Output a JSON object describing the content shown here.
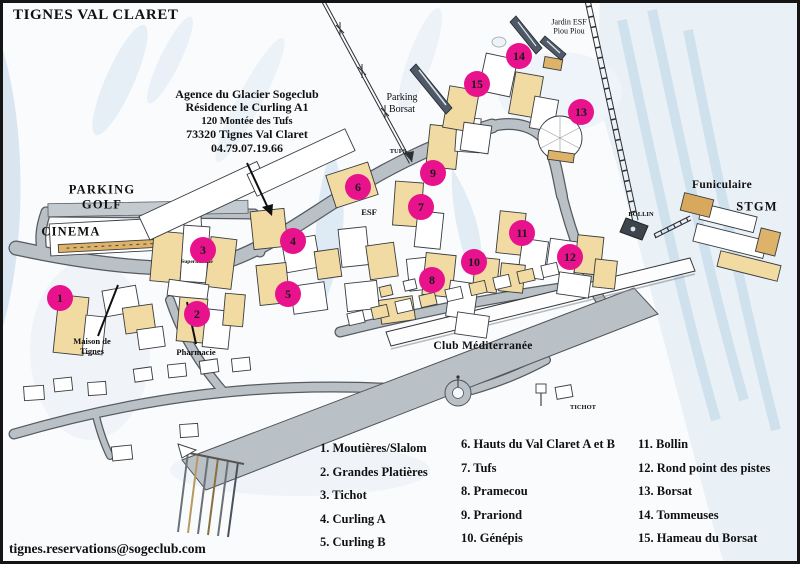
{
  "title": "TIGNES VAL CLARET",
  "agency": {
    "lines": [
      "Agence du Glacier Sogeclub",
      "Résidence le Curling A1",
      "120 Montée des Tufs",
      "73320 Tignes Val Claret",
      "04.79.07.19.66"
    ]
  },
  "contact_email": "tignes.reservations@sogeclub.com",
  "colors": {
    "marker": "#e8128d",
    "road": "#b9c0c6",
    "building_tan": "#f1dba2"
  },
  "map_labels": [
    {
      "id": "parking-golf",
      "lines": [
        "PARKING",
        "GOLF"
      ],
      "x": 102,
      "y": 197,
      "cls": "lbl-lg"
    },
    {
      "id": "cinema",
      "lines": [
        "CINEMA"
      ],
      "x": 71,
      "y": 232,
      "cls": "lbl-lg"
    },
    {
      "id": "parking-borsat",
      "lines": [
        "Parking",
        "Borsat"
      ],
      "x": 402,
      "y": 104,
      "cls": "lbl-md-reg"
    },
    {
      "id": "jardin-esf",
      "lines": [
        "Jardin ESF",
        "Piou Piou"
      ],
      "x": 569,
      "y": 27,
      "cls": "lbl-sm-reg"
    },
    {
      "id": "tufs",
      "lines": [
        "TUFS"
      ],
      "x": 398,
      "y": 152,
      "cls": "lbl-xs"
    },
    {
      "id": "esf",
      "lines": [
        "ESF"
      ],
      "x": 369,
      "y": 212,
      "cls": "lbl-sm-bold"
    },
    {
      "id": "funiculaire",
      "lines": [
        "Funiculaire"
      ],
      "x": 722,
      "y": 186,
      "cls": "lbl-md-bold"
    },
    {
      "id": "stgm",
      "lines": [
        "STGM"
      ],
      "x": 757,
      "y": 207,
      "cls": "lbl-lg"
    },
    {
      "id": "bollin",
      "lines": [
        "BOLLIN"
      ],
      "x": 641,
      "y": 215,
      "cls": "lbl-xs"
    },
    {
      "id": "club-mediterranee",
      "lines": [
        "Club Méditerranée"
      ],
      "x": 483,
      "y": 347,
      "cls": "lbl-md-bold"
    },
    {
      "id": "tichot",
      "lines": [
        "TICHOT"
      ],
      "x": 583,
      "y": 408,
      "cls": "lbl-xs"
    },
    {
      "id": "maison-de-tignes",
      "lines": [
        "Maison de",
        "Tignes"
      ],
      "x": 92,
      "y": 346,
      "cls": "lbl-sm-bold"
    },
    {
      "id": "pharmacie",
      "lines": [
        "Pharmacie"
      ],
      "x": 196,
      "y": 352,
      "cls": "lbl-sm-bold"
    },
    {
      "id": "supermarche",
      "lines": [
        "Supermarché"
      ],
      "x": 197,
      "y": 262,
      "cls": "lbl-xxs"
    }
  ],
  "markers": [
    {
      "n": "1",
      "x": 60,
      "y": 298
    },
    {
      "n": "2",
      "x": 197,
      "y": 314
    },
    {
      "n": "3",
      "x": 203,
      "y": 250
    },
    {
      "n": "4",
      "x": 293,
      "y": 241
    },
    {
      "n": "5",
      "x": 288,
      "y": 294
    },
    {
      "n": "6",
      "x": 358,
      "y": 187
    },
    {
      "n": "7",
      "x": 421,
      "y": 207
    },
    {
      "n": "8",
      "x": 432,
      "y": 280
    },
    {
      "n": "9",
      "x": 433,
      "y": 173
    },
    {
      "n": "10",
      "x": 474,
      "y": 262
    },
    {
      "n": "11",
      "x": 522,
      "y": 233
    },
    {
      "n": "12",
      "x": 570,
      "y": 257
    },
    {
      "n": "13",
      "x": 581,
      "y": 112
    },
    {
      "n": "14",
      "x": 519,
      "y": 56
    },
    {
      "n": "15",
      "x": 477,
      "y": 84
    }
  ],
  "legend": {
    "columns": [
      [
        "1. Moutières/Slalom",
        "2. Grandes Platières",
        "3. Tichot",
        "4. Curling A",
        "5. Curling B"
      ],
      [
        "6. Hauts du Val Claret A et B",
        "7. Tufs",
        "8. Pramecou",
        "9. Prariond",
        "10. Génépis"
      ],
      [
        "11. Bollin",
        "12. Rond point des pistes",
        "13. Borsat",
        "14. Tommeuses",
        "15. Hameau du Borsat"
      ]
    ]
  }
}
